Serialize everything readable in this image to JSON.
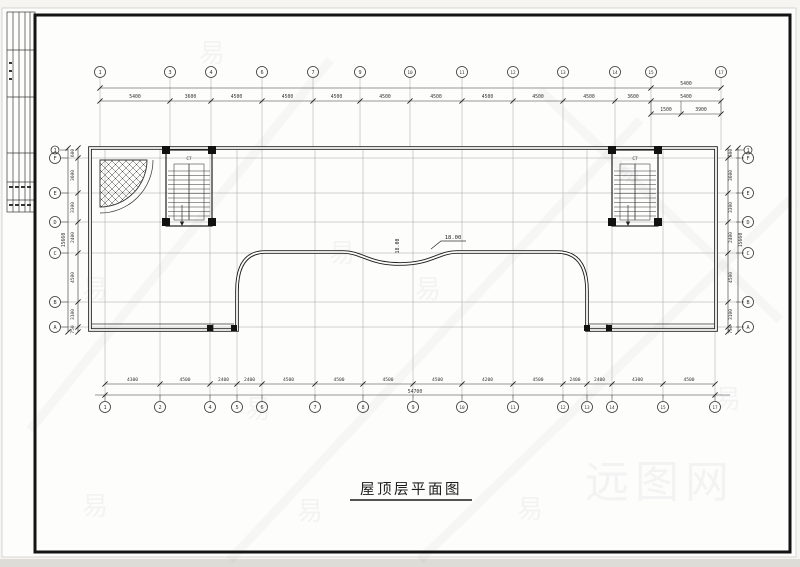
{
  "sheet": {
    "title": "屋顶层平面图"
  },
  "stair_label": "C7",
  "elevation": {
    "flag": "18.00",
    "vertical": "18.00"
  },
  "watermark": {
    "glyph": "易",
    "logo": "远图网"
  },
  "axes": {
    "top": {
      "bubbles": [
        "1",
        "3",
        "4",
        "6",
        "7",
        "9",
        "10",
        "11",
        "12",
        "13",
        "14",
        "15",
        "17"
      ],
      "dims": [
        "5400",
        "3600",
        "4500",
        "4500",
        "4500",
        "4500",
        "4500",
        "4500",
        "4500",
        "4500",
        "3600",
        "5400"
      ],
      "right_stack": {
        "overall": "5400",
        "subs": [
          "1500",
          "3900"
        ]
      }
    },
    "bottom": {
      "bubbles": [
        "1",
        "2",
        "4",
        "5",
        "6",
        "7",
        "8",
        "9",
        "10",
        "11",
        "12",
        "13",
        "14",
        "15",
        "17"
      ],
      "dims": [
        "4300",
        "4500",
        "2400",
        "2400",
        "4500",
        "4500",
        "4500",
        "4500",
        "4200",
        "4500",
        "2400",
        "2400",
        "4300",
        "4500"
      ],
      "total": "54700"
    },
    "left": {
      "bubbles": [
        "1",
        "F",
        "E",
        "D",
        "C",
        "B",
        "A"
      ],
      "dims": [
        "600",
        "3600",
        "3300",
        "2400",
        "4500",
        "3100",
        "750"
      ],
      "total": "15660"
    },
    "right": {
      "bubbles": [
        "1",
        "F",
        "E",
        "D",
        "C",
        "B",
        "A"
      ],
      "dims": [
        "600",
        "3600",
        "3300",
        "2400",
        "4500",
        "3100",
        "750"
      ],
      "total": "15660"
    }
  }
}
